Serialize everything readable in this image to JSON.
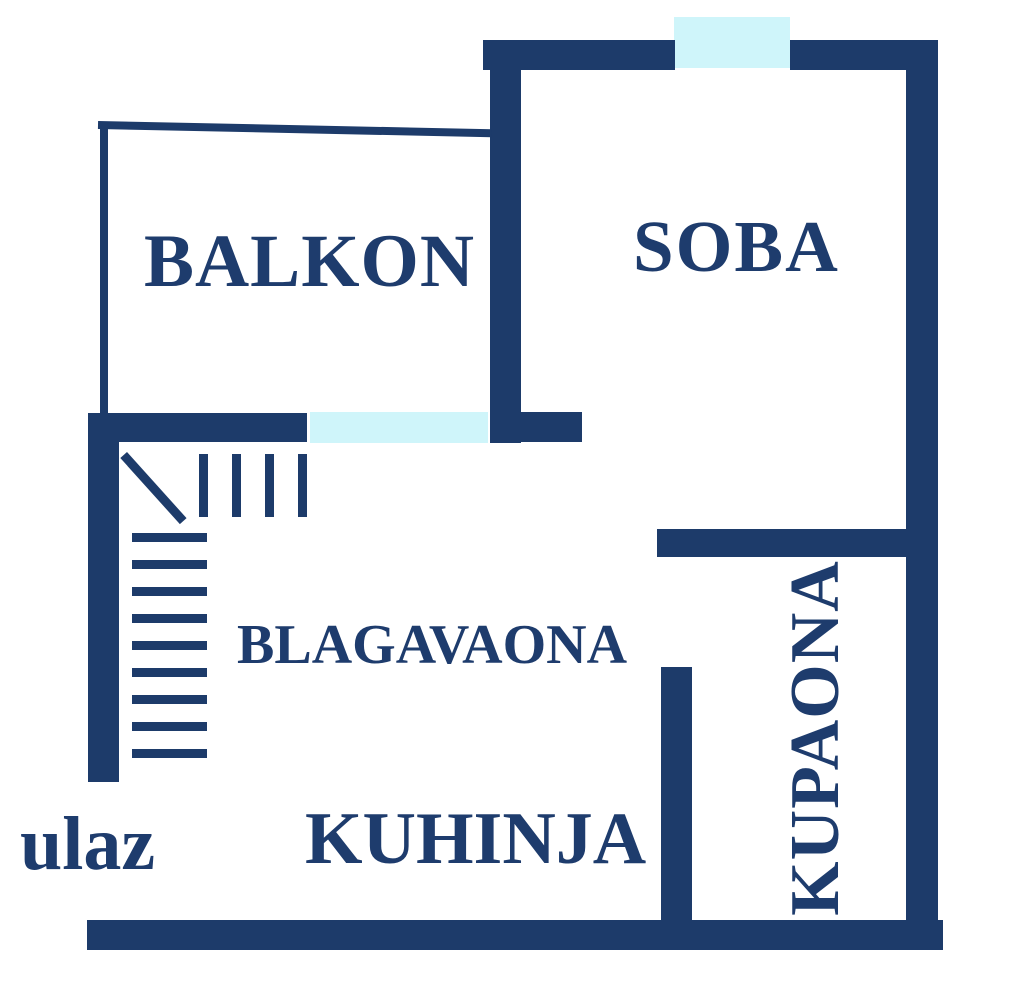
{
  "title": "Apartment floor plan",
  "colors": {
    "wall": "#1d3b6a",
    "window": "#cff5fa",
    "text": "#1e3c6d",
    "background": "#ffffff"
  },
  "rooms": {
    "balkon": {
      "label": "BALKON"
    },
    "soba": {
      "label": "SOBA"
    },
    "blagavaona": {
      "label": "BLAGAVAONA"
    },
    "kuhinja": {
      "label": "KUHINJA"
    },
    "kupaona": {
      "label": "KUPAONA"
    }
  },
  "entrance": {
    "label": "ulaz"
  },
  "features": {
    "windows": [
      "soba-window",
      "balkon-window"
    ],
    "stairs": "staircase",
    "wall_count": 11
  }
}
